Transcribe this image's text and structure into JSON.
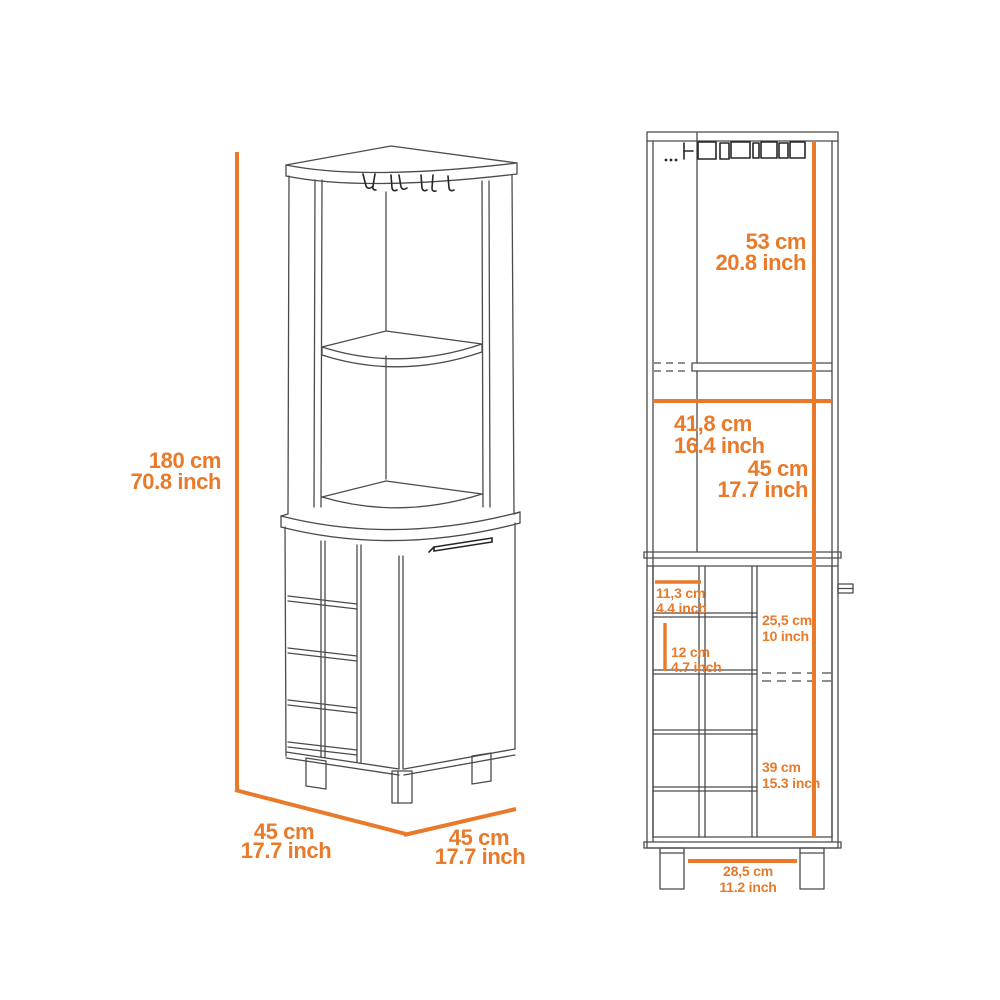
{
  "colors": {
    "accent": "#e87a2a",
    "line": "#4b4b4b",
    "dark_line": "#262626",
    "background": "#ffffff"
  },
  "perspective_view": {
    "height": {
      "cm": "180 cm",
      "inch": "70.8 inch"
    },
    "depth": {
      "cm": "45 cm",
      "inch": "17.7 inch"
    },
    "width": {
      "cm": "45 cm",
      "inch": "17.7 inch"
    }
  },
  "front_view": {
    "upper_opening_height": {
      "cm": "53 cm",
      "inch": "20.8 inch"
    },
    "interior_width": {
      "cm": "41,8 cm",
      "inch": "16.4 inch"
    },
    "lower_opening_height": {
      "cm": "45 cm",
      "inch": "17.7 inch"
    },
    "bottle_slot_width": {
      "cm": "11,3 cm",
      "inch": "4.4 inch"
    },
    "upper_door_section_height": {
      "cm": "25,5 cm",
      "inch": "10 inch"
    },
    "bottle_slot_height": {
      "cm": "12 cm",
      "inch": "4.7 inch"
    },
    "lower_door_section_height": {
      "cm": "39 cm",
      "inch": "15.3 inch"
    },
    "leg_span": {
      "cm": "28,5 cm",
      "inch": "11.2 inch"
    }
  }
}
